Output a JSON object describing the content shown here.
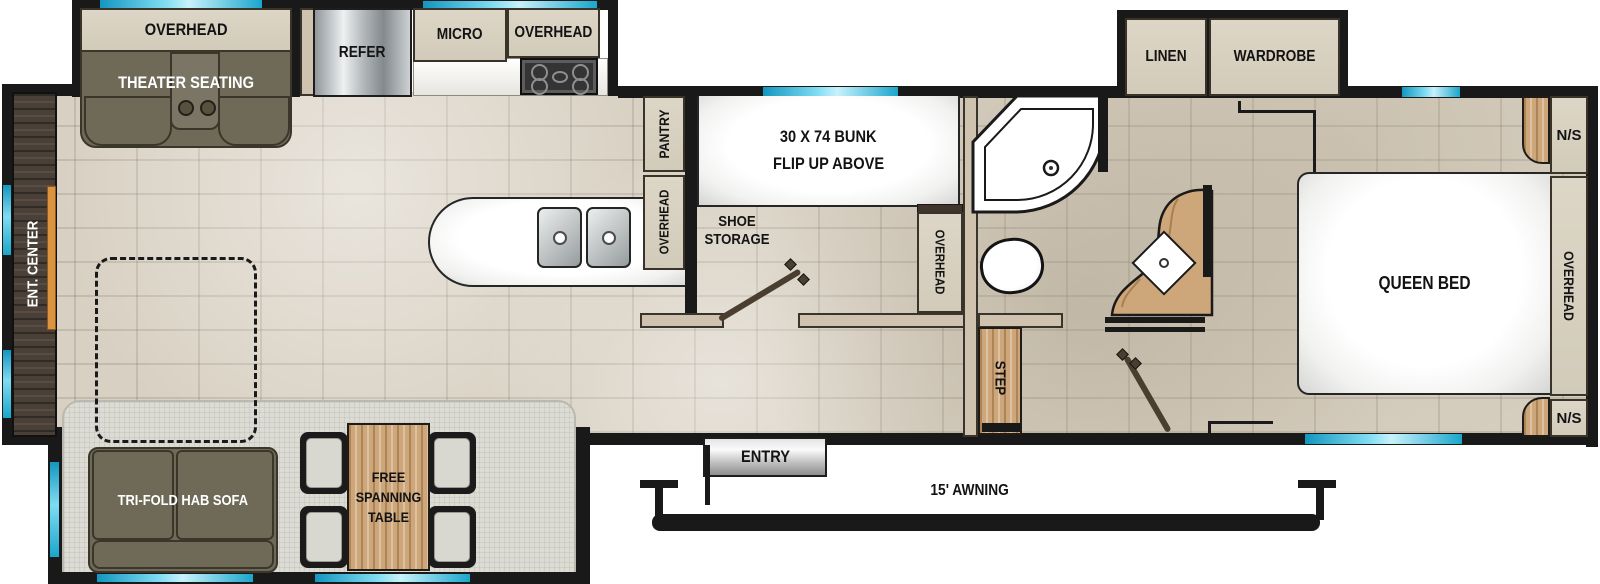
{
  "plan": {
    "rear": {
      "ent_center": "ENT. CENTER"
    },
    "theater": {
      "overhead": "OVERHEAD",
      "label": "THEATER SEATING"
    },
    "kitchen": {
      "refer": "REFER",
      "micro": "MICRO",
      "overhead_top": "OVERHEAD",
      "pantry": "PANTRY",
      "overhead_strip": "OVERHEAD"
    },
    "bunkroom": {
      "bunk_line1": "30 X 74 BUNK",
      "bunk_line2": "FLIP UP ABOVE",
      "shoe_storage": "SHOE STORAGE",
      "overhead_strip": "OVERHEAD"
    },
    "bedroom": {
      "linen": "LINEN",
      "wardrobe": "WARDROBE",
      "queen_bed": "QUEEN BED",
      "ns_top": "N/S",
      "ns_bottom": "N/S",
      "overhead_strip": "OVERHEAD",
      "step": "STEP"
    },
    "dinette": {
      "sofa": "TRI-FOLD HAB SOFA",
      "table": "FREE SPANNING TABLE"
    },
    "exterior": {
      "entry": "ENTRY",
      "awning": "15' AWNING"
    }
  },
  "colors": {
    "window_accent": "#2ab5d8",
    "wall": "#191919",
    "cabinet": "#d9d2c1",
    "sofa_olive": "#6f6a58",
    "wood": "#cda77a",
    "dark_wood": "#4a4037",
    "floor_tile": "#d8d0c2",
    "slide_floor": "#dcdcd5",
    "fireplace_orange": "#dd9440"
  }
}
